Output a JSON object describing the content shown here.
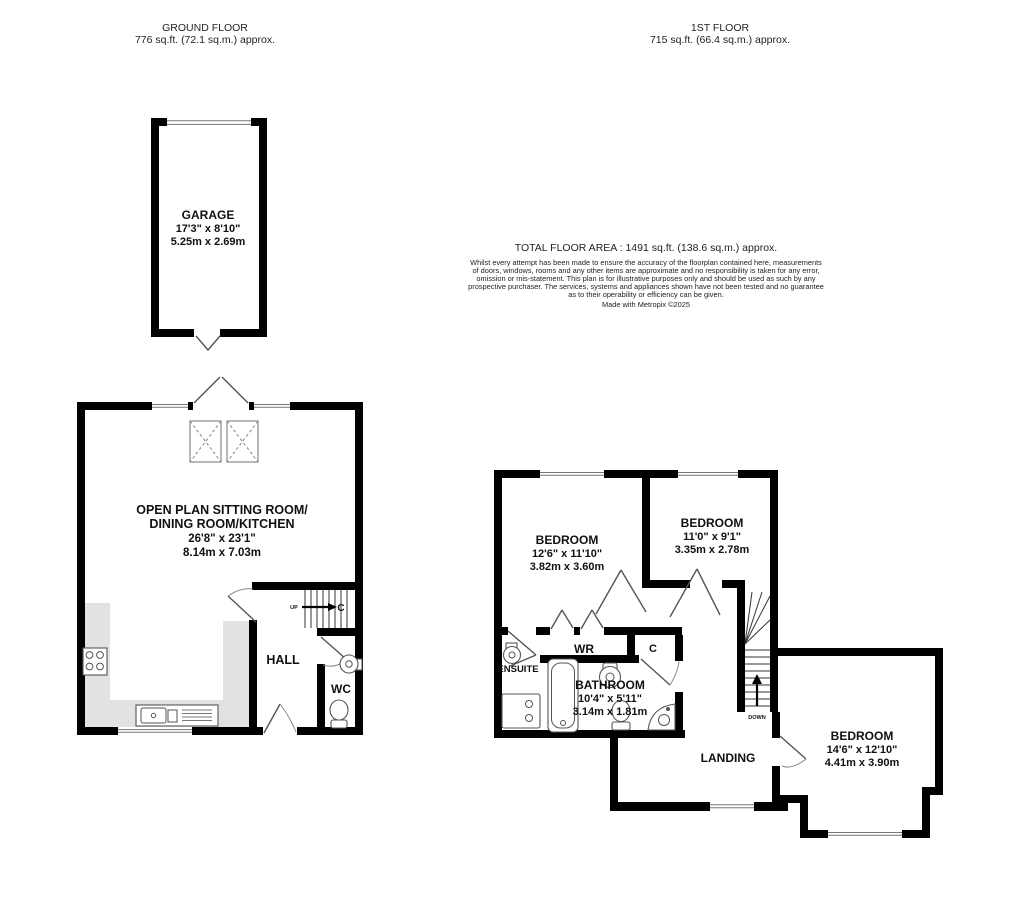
{
  "headers": {
    "ground": {
      "title": "GROUND FLOOR",
      "area": "776 sq.ft. (72.1 sq.m.) approx."
    },
    "first": {
      "title": "1ST FLOOR",
      "area": "715 sq.ft. (66.4 sq.m.) approx."
    }
  },
  "summary": {
    "total": "TOTAL FLOOR AREA : 1491 sq.ft. (138.6 sq.m.) approx.",
    "disclaimer_lines": [
      "Whilst every attempt has been made to ensure the accuracy of the floorplan contained here, measurements",
      "of doors, windows, rooms and any other items are approximate and no responsibility is taken for any error,",
      "omission or mis-statement. This plan is for illustrative purposes only and should be used as such by any",
      "prospective purchaser. The services, systems and appliances shown have not been tested and no guarantee",
      "as to their operability or efficiency can be given."
    ],
    "credit": "Made with Metropix ©2025"
  },
  "ground_floor": {
    "garage": {
      "name": "GARAGE",
      "imperial": "17'3\"  x 8'10\"",
      "metric": "5.25m  x 2.69m"
    },
    "open_plan": {
      "line1": "OPEN PLAN SITTING ROOM/",
      "line2": "DINING ROOM/KITCHEN",
      "imperial": "26'8\"  x 23'1\"",
      "metric": "8.14m  x 7.03m"
    },
    "hall_label": "HALL",
    "wc_label": "WC",
    "cupboard_label": "C",
    "up_label": "UP"
  },
  "first_floor": {
    "bedroom1": {
      "name": "BEDROOM",
      "imperial": "12'6\"  x 11'10\"",
      "metric": "3.82m  x 3.60m"
    },
    "bedroom2": {
      "name": "BEDROOM",
      "imperial": "11'0\"  x 9'1\"",
      "metric": "3.35m  x 2.78m"
    },
    "bedroom3": {
      "name": "BEDROOM",
      "imperial": "14'6\"  x 12'10\"",
      "metric": "4.41m  x 3.90m"
    },
    "bathroom": {
      "name": "BATHROOM",
      "imperial": "10'4\"  x 5'11\"",
      "metric": "3.14m  x 1.81m"
    },
    "ensuite_label": "ENSUITE",
    "wr_label": "WR",
    "cupboard_label": "C",
    "landing_label": "LANDING",
    "down_label": "DOWN"
  },
  "colors": {
    "wall": "#000000",
    "counter": "#e2e2e2",
    "background": "#ffffff"
  }
}
